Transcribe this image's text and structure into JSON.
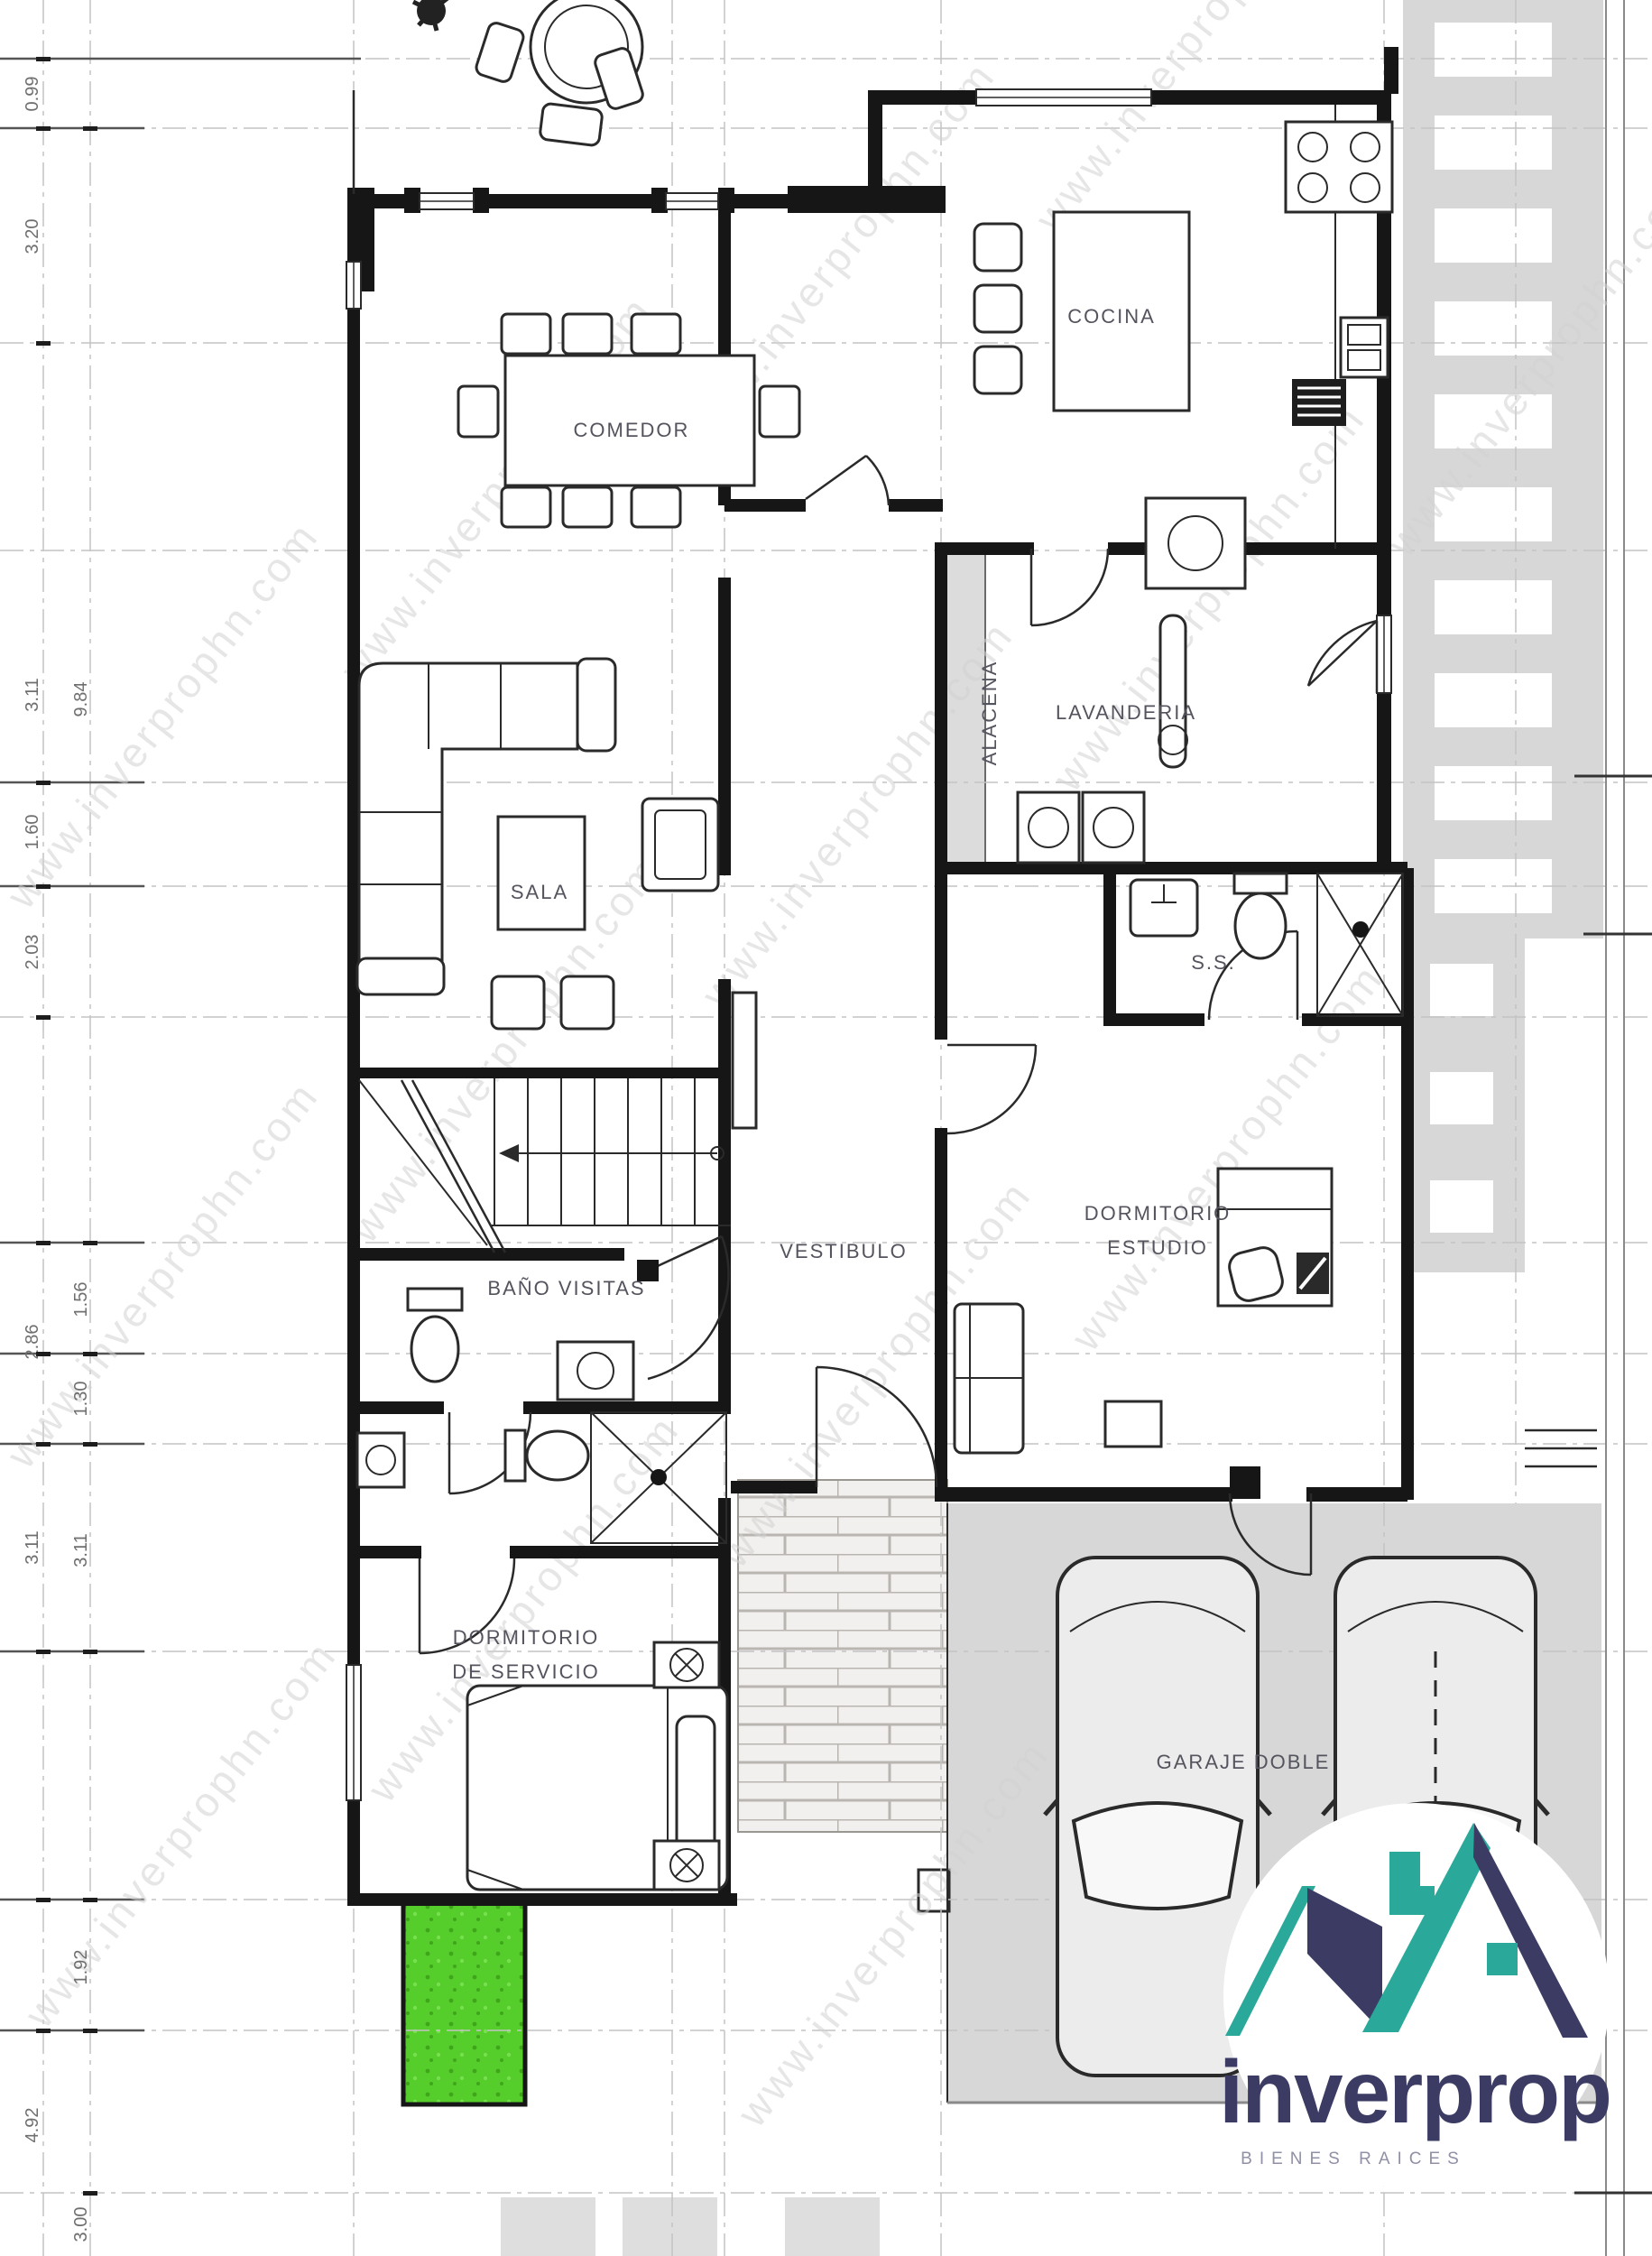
{
  "watermark": {
    "text": "www.inverprophn.com",
    "color": "#d2d2d2"
  },
  "rooms": {
    "cocina": "COCINA",
    "comedor": "COMEDOR",
    "sala": "SALA",
    "alacena": "ALACENA",
    "lavanderia": "LAVANDERIA",
    "ss": "S.S.",
    "dormitorio_estudio_1": "DORMITORIO",
    "dormitorio_estudio_2": "ESTUDIO",
    "bano_visitas": "BAÑO VISITAS",
    "vestibulo": "VESTIBULO",
    "dormitorio_servicio_1": "DORMITORIO",
    "dormitorio_servicio_2": "DE SERVICIO",
    "garaje": "GARAJE DOBLE"
  },
  "dimensions": {
    "left_outer": [
      "0.99",
      "3.20",
      "3.11",
      "1.60",
      "2.03",
      "2.86",
      "3.11",
      "4.92"
    ],
    "left_inner": [
      "9.84",
      "1.56",
      "1.30",
      "3.11",
      "1.92",
      "3.00"
    ]
  },
  "logo": {
    "brand": "inverprop",
    "tagline": "BIENES RAICES",
    "teal": "#2aa99b",
    "navy": "#3b3b63"
  },
  "colors": {
    "wall": "#161616",
    "paving_gray": "#d7d7d7",
    "grass_green": "#55cd2a",
    "label": "#54545e",
    "dimension_text": "#6f6f6f"
  }
}
